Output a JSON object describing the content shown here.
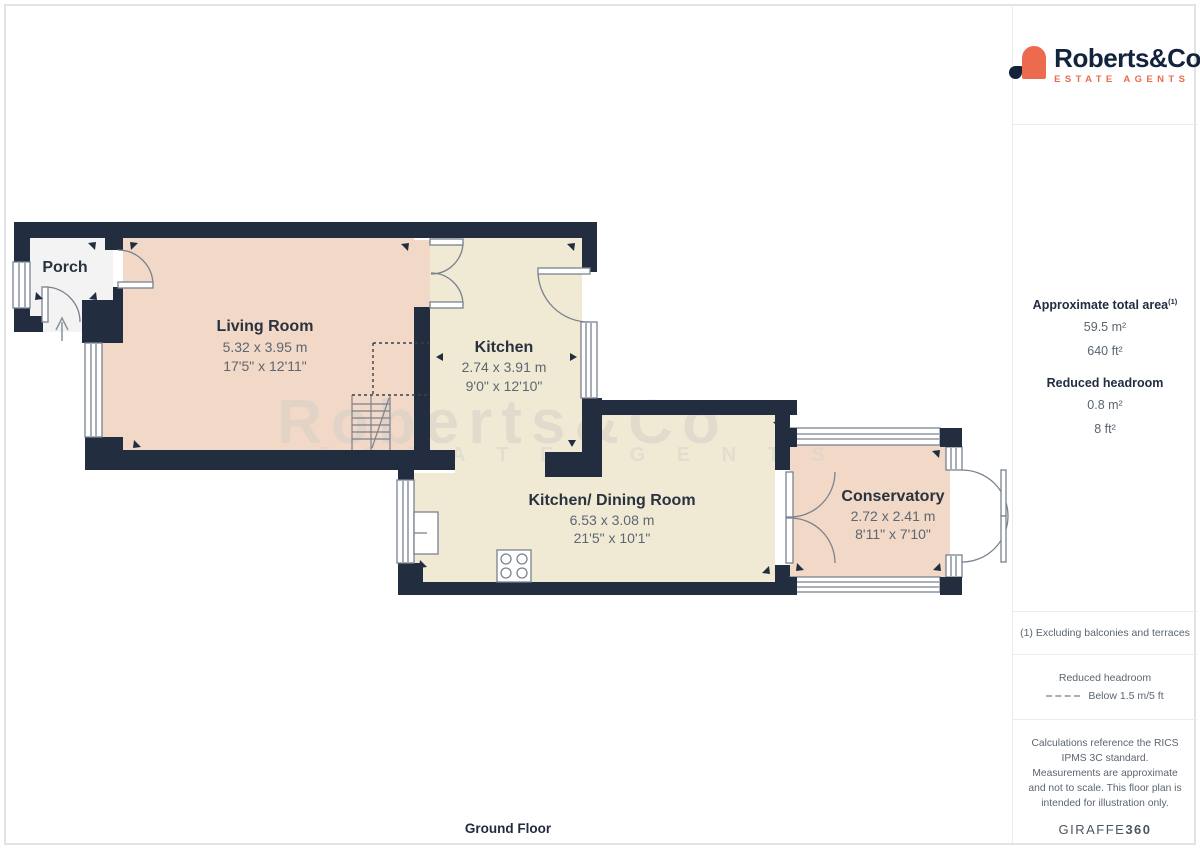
{
  "branding": {
    "name": "Roberts&Co",
    "tagline": "ESTATE AGENTS",
    "accent_orange": "#ec6a4d",
    "navy": "#222e40",
    "floor_pink": "#f2d8c6",
    "floor_cream": "#f0ead5"
  },
  "sidebar": {
    "area": {
      "title": "Approximate total area",
      "title_note": "(1)",
      "sqm": "59.5 m²",
      "sqft": "640 ft²",
      "reduced_title": "Reduced headroom",
      "reduced_sqm": "0.8 m²",
      "reduced_sqft": "8 ft²"
    },
    "footnote": "(1) Excluding balconies and terraces",
    "legend": {
      "title": "Reduced headroom",
      "item": "Below 1.5 m/5 ft"
    },
    "disclaimer": "Calculations reference the RICS IPMS 3C standard. Measurements are approximate and not to scale. This floor plan is intended for illustration only.",
    "brand_footer": {
      "name": "GIRAFFE",
      "suffix": "360"
    }
  },
  "floorplan": {
    "floor_label": "Ground Floor",
    "watermark": {
      "line1": "Roberts&Co",
      "line2": "E S T A T E   A G E N T S"
    },
    "rooms": [
      {
        "name": "Porch",
        "dims_m": "",
        "dims_ft": ""
      },
      {
        "name": "Living Room",
        "dims_m": "5.32 x 3.95 m",
        "dims_ft": "17'5\" x 12'11\""
      },
      {
        "name": "Kitchen",
        "dims_m": "2.74 x 3.91 m",
        "dims_ft": "9'0\" x 12'10\""
      },
      {
        "name": "Kitchen/ Dining Room",
        "dims_m": "6.53 x 3.08 m",
        "dims_ft": "21'5\" x 10'1\""
      },
      {
        "name": "Conservatory",
        "dims_m": "2.72 x 2.41 m",
        "dims_ft": "8'11\" x 7'10\""
      }
    ]
  }
}
